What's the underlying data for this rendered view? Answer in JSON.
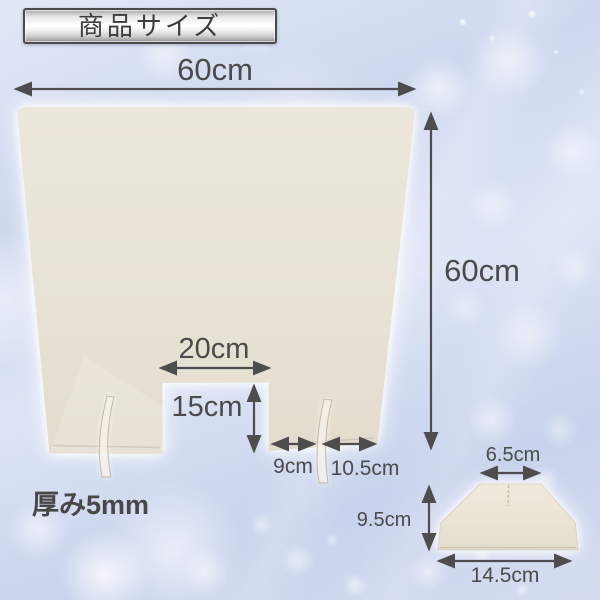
{
  "badge": {
    "label": "商品サイズ"
  },
  "main_panel": {
    "width_label": "60cm",
    "height_label": "60cm",
    "notch_width_label": "20cm",
    "notch_depth_label": "15cm",
    "notch_to_slot_label": "9cm",
    "slot_to_edge_label": "10.5cm",
    "thickness_label": "厚み5mm"
  },
  "foot_piece": {
    "top_width_label": "6.5cm",
    "height_label": "9.5cm",
    "bottom_width_label": "14.5cm"
  },
  "colors": {
    "panel_fill": "#e9e3d6",
    "arrow": "#4d4d4d",
    "dimension_text": "#4b4b4b",
    "background_base": "#cfd8ef",
    "badge_border": "#4a4a4a"
  }
}
